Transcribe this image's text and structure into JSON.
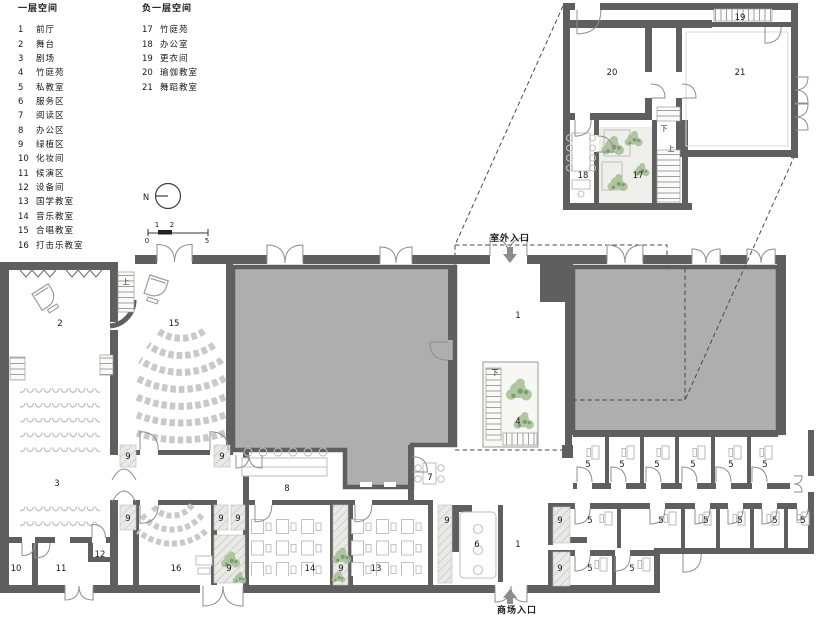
{
  "colors": {
    "paper": "#ffffff",
    "ink": "#1a1a1a",
    "wall": "#5f5f5f",
    "fill_gray": "#aeaeae",
    "hatch": "#cfcfcf",
    "furniture": "#c2c2c2",
    "plant": "#a4bf94",
    "plant_dark": "#7d9e6d",
    "dash": "#4a4a4a"
  },
  "legend": {
    "floor1": {
      "title": "一层空间",
      "items": [
        {
          "n": "1",
          "t": "前厅"
        },
        {
          "n": "2",
          "t": "舞台"
        },
        {
          "n": "3",
          "t": "剧场"
        },
        {
          "n": "4",
          "t": "竹庭苑"
        },
        {
          "n": "5",
          "t": "私教室"
        },
        {
          "n": "6",
          "t": "服务区"
        },
        {
          "n": "7",
          "t": "阅读区"
        },
        {
          "n": "8",
          "t": "办公区"
        },
        {
          "n": "9",
          "t": "绿植区"
        },
        {
          "n": "10",
          "t": "化妆间"
        },
        {
          "n": "11",
          "t": "候演区"
        },
        {
          "n": "12",
          "t": "设备间"
        },
        {
          "n": "13",
          "t": "国学教室"
        },
        {
          "n": "14",
          "t": "音乐教室"
        },
        {
          "n": "15",
          "t": "合唱教室"
        },
        {
          "n": "16",
          "t": "打击乐教室"
        }
      ]
    },
    "basement": {
      "title": "负一层空间",
      "items": [
        {
          "n": "17",
          "t": "竹庭苑"
        },
        {
          "n": "18",
          "t": "办公室"
        },
        {
          "n": "19",
          "t": "更衣间"
        },
        {
          "n": "20",
          "t": "瑜伽教室"
        },
        {
          "n": "21",
          "t": "舞蹈教室"
        }
      ]
    }
  },
  "compass": {
    "label": "N"
  },
  "scalebar": {
    "t0": "0",
    "t1": "1",
    "t2": "2",
    "t5": "5"
  },
  "entrances": {
    "outdoor": "室外入口",
    "mall": "商场入口"
  },
  "stairs": {
    "up": "上",
    "down": "下"
  },
  "rooms": {
    "front_hall": "1",
    "stage": "2",
    "theater": "3",
    "bamboo_court": "4",
    "private_classroom": "5",
    "service_area": "6",
    "reading_area": "7",
    "office_area": "8",
    "green_area": "9",
    "makeup_room": "10",
    "waiting_area": "11",
    "equipment_room": "12",
    "guoxue_classroom": "13",
    "music_classroom": "14",
    "chorus_classroom": "15",
    "percussion_classroom": "16",
    "b1_bamboo_court": "17",
    "b1_office": "18",
    "changing_room": "19",
    "yoga_classroom": "20",
    "dance_classroom": "21"
  }
}
